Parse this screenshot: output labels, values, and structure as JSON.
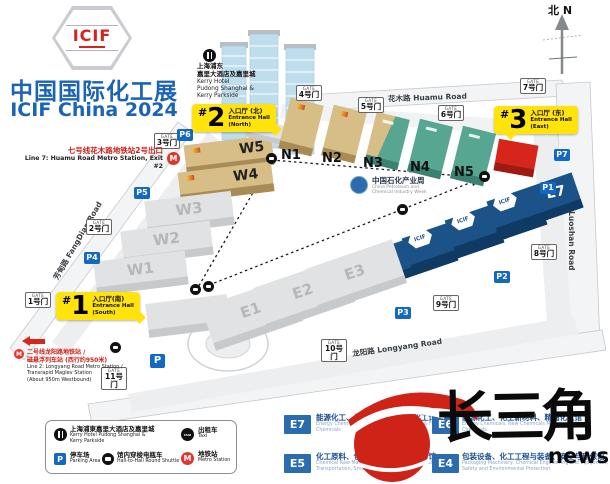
{
  "title": {
    "logo": "ICIF",
    "cn": "中国国际化工展",
    "en": "ICIF China 2024"
  },
  "compass": {
    "label": "北 N"
  },
  "notes": {
    "line7": {
      "cn": "七号线花木路地铁站2号出口",
      "en": "Line 7: Huamu Road Metro Station, Exit #2"
    },
    "line2": {
      "cn1": "二号线龙阳路地铁站 /",
      "cn2": "磁悬浮列车站 (西行约950米)",
      "en1": "Line 2: Longyang Road Metro Station /",
      "en2": "Transrapid Maglev Station",
      "en3": "(About 950m Westbound)"
    },
    "kerry": {
      "cn1": "上海浦东",
      "cn2": "嘉里大酒店及嘉里城",
      "en1": "Kerry Hotel",
      "en2": "Pudong Shanghai &",
      "en3": "Kerry Parkside"
    },
    "petro": {
      "cn": "中国石化产业周",
      "en1": "China Petroleum and",
      "en2": "Chemical Industry Week"
    }
  },
  "roads": {
    "huamu": "花木路  Huamu Road",
    "luoshan": "罗山路  Luoshan Road",
    "longyang": "龙阳路  Longyang Road",
    "fangdian": "芳甸路  FangDian Road"
  },
  "entrances": {
    "s": {
      "hash": "#",
      "num": "1",
      "cn": "入口厅(南)",
      "en1": "Entrance Hall",
      "en2": "(South)"
    },
    "n": {
      "hash": "#",
      "num": "2",
      "cn": "入口厅 (北)",
      "en1": "Entrance Hall",
      "en2": "(North)"
    },
    "e": {
      "hash": "#",
      "num": "3",
      "cn": "入口厅 (东)",
      "en1": "Entrance Hall",
      "en2": "(East)"
    }
  },
  "gate_word": "GATE",
  "gates": [
    "1号门",
    "2号门",
    "3号门",
    "4号门",
    "5号门",
    "6号门",
    "7号门",
    "8号门",
    "9号门",
    "10号门",
    "11号门"
  ],
  "parking": [
    "P1",
    "P2",
    "P3",
    "P4",
    "P5",
    "P6",
    "P7",
    "P"
  ],
  "halls": {
    "w1": "W1",
    "w2": "W2",
    "w3": "W3",
    "w4": "W4",
    "w5": "W5",
    "n1": "N1",
    "n2": "N2",
    "n3": "N3",
    "n4": "N4",
    "n5": "N5",
    "e1": "E1",
    "e2": "E2",
    "e3": "E3",
    "e4": "E4",
    "e5": "E5",
    "e6": "E6",
    "e7": "E7"
  },
  "roof_logo": "ICIF",
  "legend": {
    "kerry": {
      "cn": "上海浦東嘉里大酒店及嘉里城",
      "en1": "Kerry Hotel Pudong Shanghai &",
      "en2": "Kerry Parkside"
    },
    "taxi": {
      "cn": "出租车",
      "en": "Taxi",
      "icon_text": "TAXI"
    },
    "parking": {
      "cn": "停车场",
      "en": "Parking Area",
      "icon_text": "P"
    },
    "shuttle": {
      "cn": "馆内穿梭电瓶车",
      "en": "Hall-to-Hall Round Shuttle"
    },
    "metro": {
      "cn": "地铁站",
      "en": "Metro Station",
      "icon_text": "M"
    }
  },
  "hall_legend": [
    {
      "code": "E7",
      "cn": "能源化工、化工新材料、精细化工馆",
      "en": "Energy Chemicals, New Chemicals Materials & Fine Chemicals"
    },
    {
      "code": "E6",
      "cn": "能源化工、化工新材料、精细化工馆",
      "en": "Energy Chemicals, New Chemicals Materials & Fine Chemicals"
    },
    {
      "code": "E5",
      "cn": "化工原料、包装与储运、智能制造馆",
      "en": "Chemical Raw Materials, Chemical Packaging, Storage & Transportation, Smart CMER"
    },
    {
      "code": "E4",
      "cn": "包装设备、化工工程与装备、安全与环保馆",
      "en": "Packaging Machinery, Chemical Engineering and Equipment, Safety and Environmental Protection"
    }
  ],
  "watermark": {
    "cn": "长三角",
    "en": "news"
  },
  "colors": {
    "accent_blue": "#1a63b5",
    "hall_tan": "#d7bd86",
    "hall_teal": "#56a692",
    "hall_blue": "#1b5389",
    "hall_gray": "#e0e2e3",
    "entrance_red": "#d6261c",
    "label_yellow": "#ffe30a",
    "parking_blue": "#1368c4",
    "metro_red": "#e4342c"
  }
}
